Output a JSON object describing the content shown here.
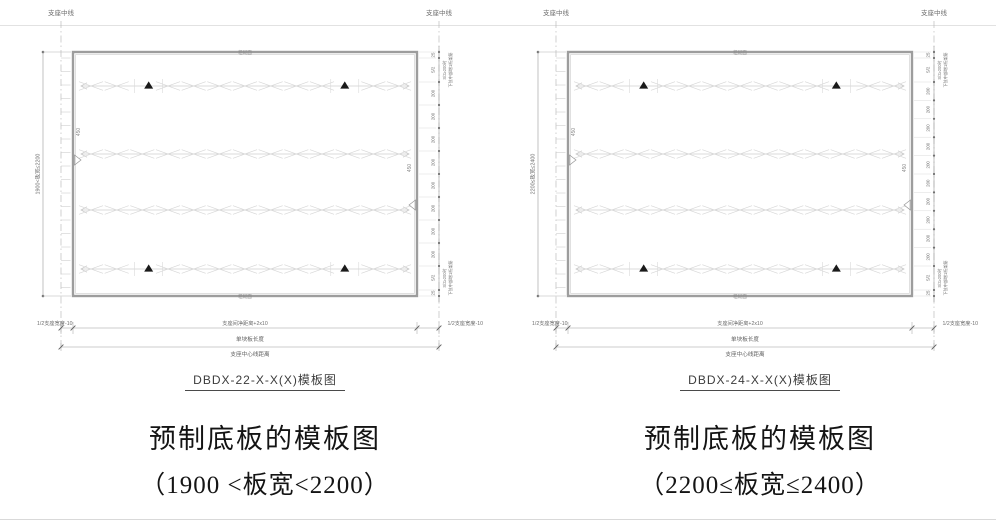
{
  "page": {
    "background": "#ffffff",
    "line_color_dark": "#8f8f8f",
    "line_color_light": "#d4d4d4",
    "anchor_color": "#1a1a1a",
    "text_color_small": "#6e6e6e"
  },
  "panels": [
    {
      "id": "left",
      "drawing_title": "DBDX-22-X-X(X)模板图",
      "caption_line1": "预制底板的模板图",
      "caption_line2": "（1900 <板宽<2200）",
      "labels": {
        "support_centerline_left": "支座中线",
        "support_centerline_right": "支座中线",
        "rough_surface_top": "粗糙面",
        "rough_surface_bottom": "粗糙面",
        "width_range_vertical": "1900<板宽≤2200",
        "edge_dim_left": "450",
        "edge_dim_right": "450",
        "half_support_left": "1/2支座宽度-10",
        "clear_span_center": "支座间净距离+2x10",
        "half_support_right": "1/2支座宽度-10",
        "board_length": "单块板长度",
        "support_cl_distance": "支座中心线距离",
        "note_line1": "S/2≥200时",
        "note_line2": "下弦中部增1桁架筋"
      },
      "geometry": {
        "truss_rows": 4,
        "rows_with_anchors": [
          0,
          3
        ],
        "anchor_fractions": [
          0.22,
          0.79
        ],
        "x_marks_per_row": 13,
        "side_chain_segments": [
          "25",
          "S/2",
          "200",
          "200",
          "200",
          "200",
          "200",
          "200",
          "200",
          "200",
          "S/2",
          "25"
        ],
        "side_chain_200_count": 8
      }
    },
    {
      "id": "right",
      "drawing_title": "DBDX-24-X-X(X)模板图",
      "caption_line1": "预制底板的模板图",
      "caption_line2": "（2200≤板宽≤2400）",
      "labels": {
        "support_centerline_left": "支座中线",
        "support_centerline_right": "支座中线",
        "rough_surface_top": "粗糙面",
        "rough_surface_bottom": "粗糙面",
        "width_range_vertical": "2200≤板宽≤2400",
        "edge_dim_left": "450",
        "edge_dim_right": "450",
        "half_support_left": "1/2支座宽度-10",
        "clear_span_center": "支座间净距离+2x10",
        "half_support_right": "1/2支座宽度-10",
        "board_length": "单块板长度",
        "support_cl_distance": "支座中心线距离",
        "note_line1": "S/2≥200时",
        "note_line2": "下弦中部增1桁架筋"
      },
      "geometry": {
        "truss_rows": 4,
        "rows_with_anchors": [
          0,
          3
        ],
        "anchor_fractions": [
          0.22,
          0.78
        ],
        "x_marks_per_row": 13,
        "side_chain_segments": [
          "25",
          "S/2",
          "200",
          "200",
          "200",
          "200",
          "200",
          "200",
          "200",
          "200",
          "200",
          "200",
          "S/2",
          "25"
        ],
        "side_chain_200_count": 10
      }
    }
  ]
}
